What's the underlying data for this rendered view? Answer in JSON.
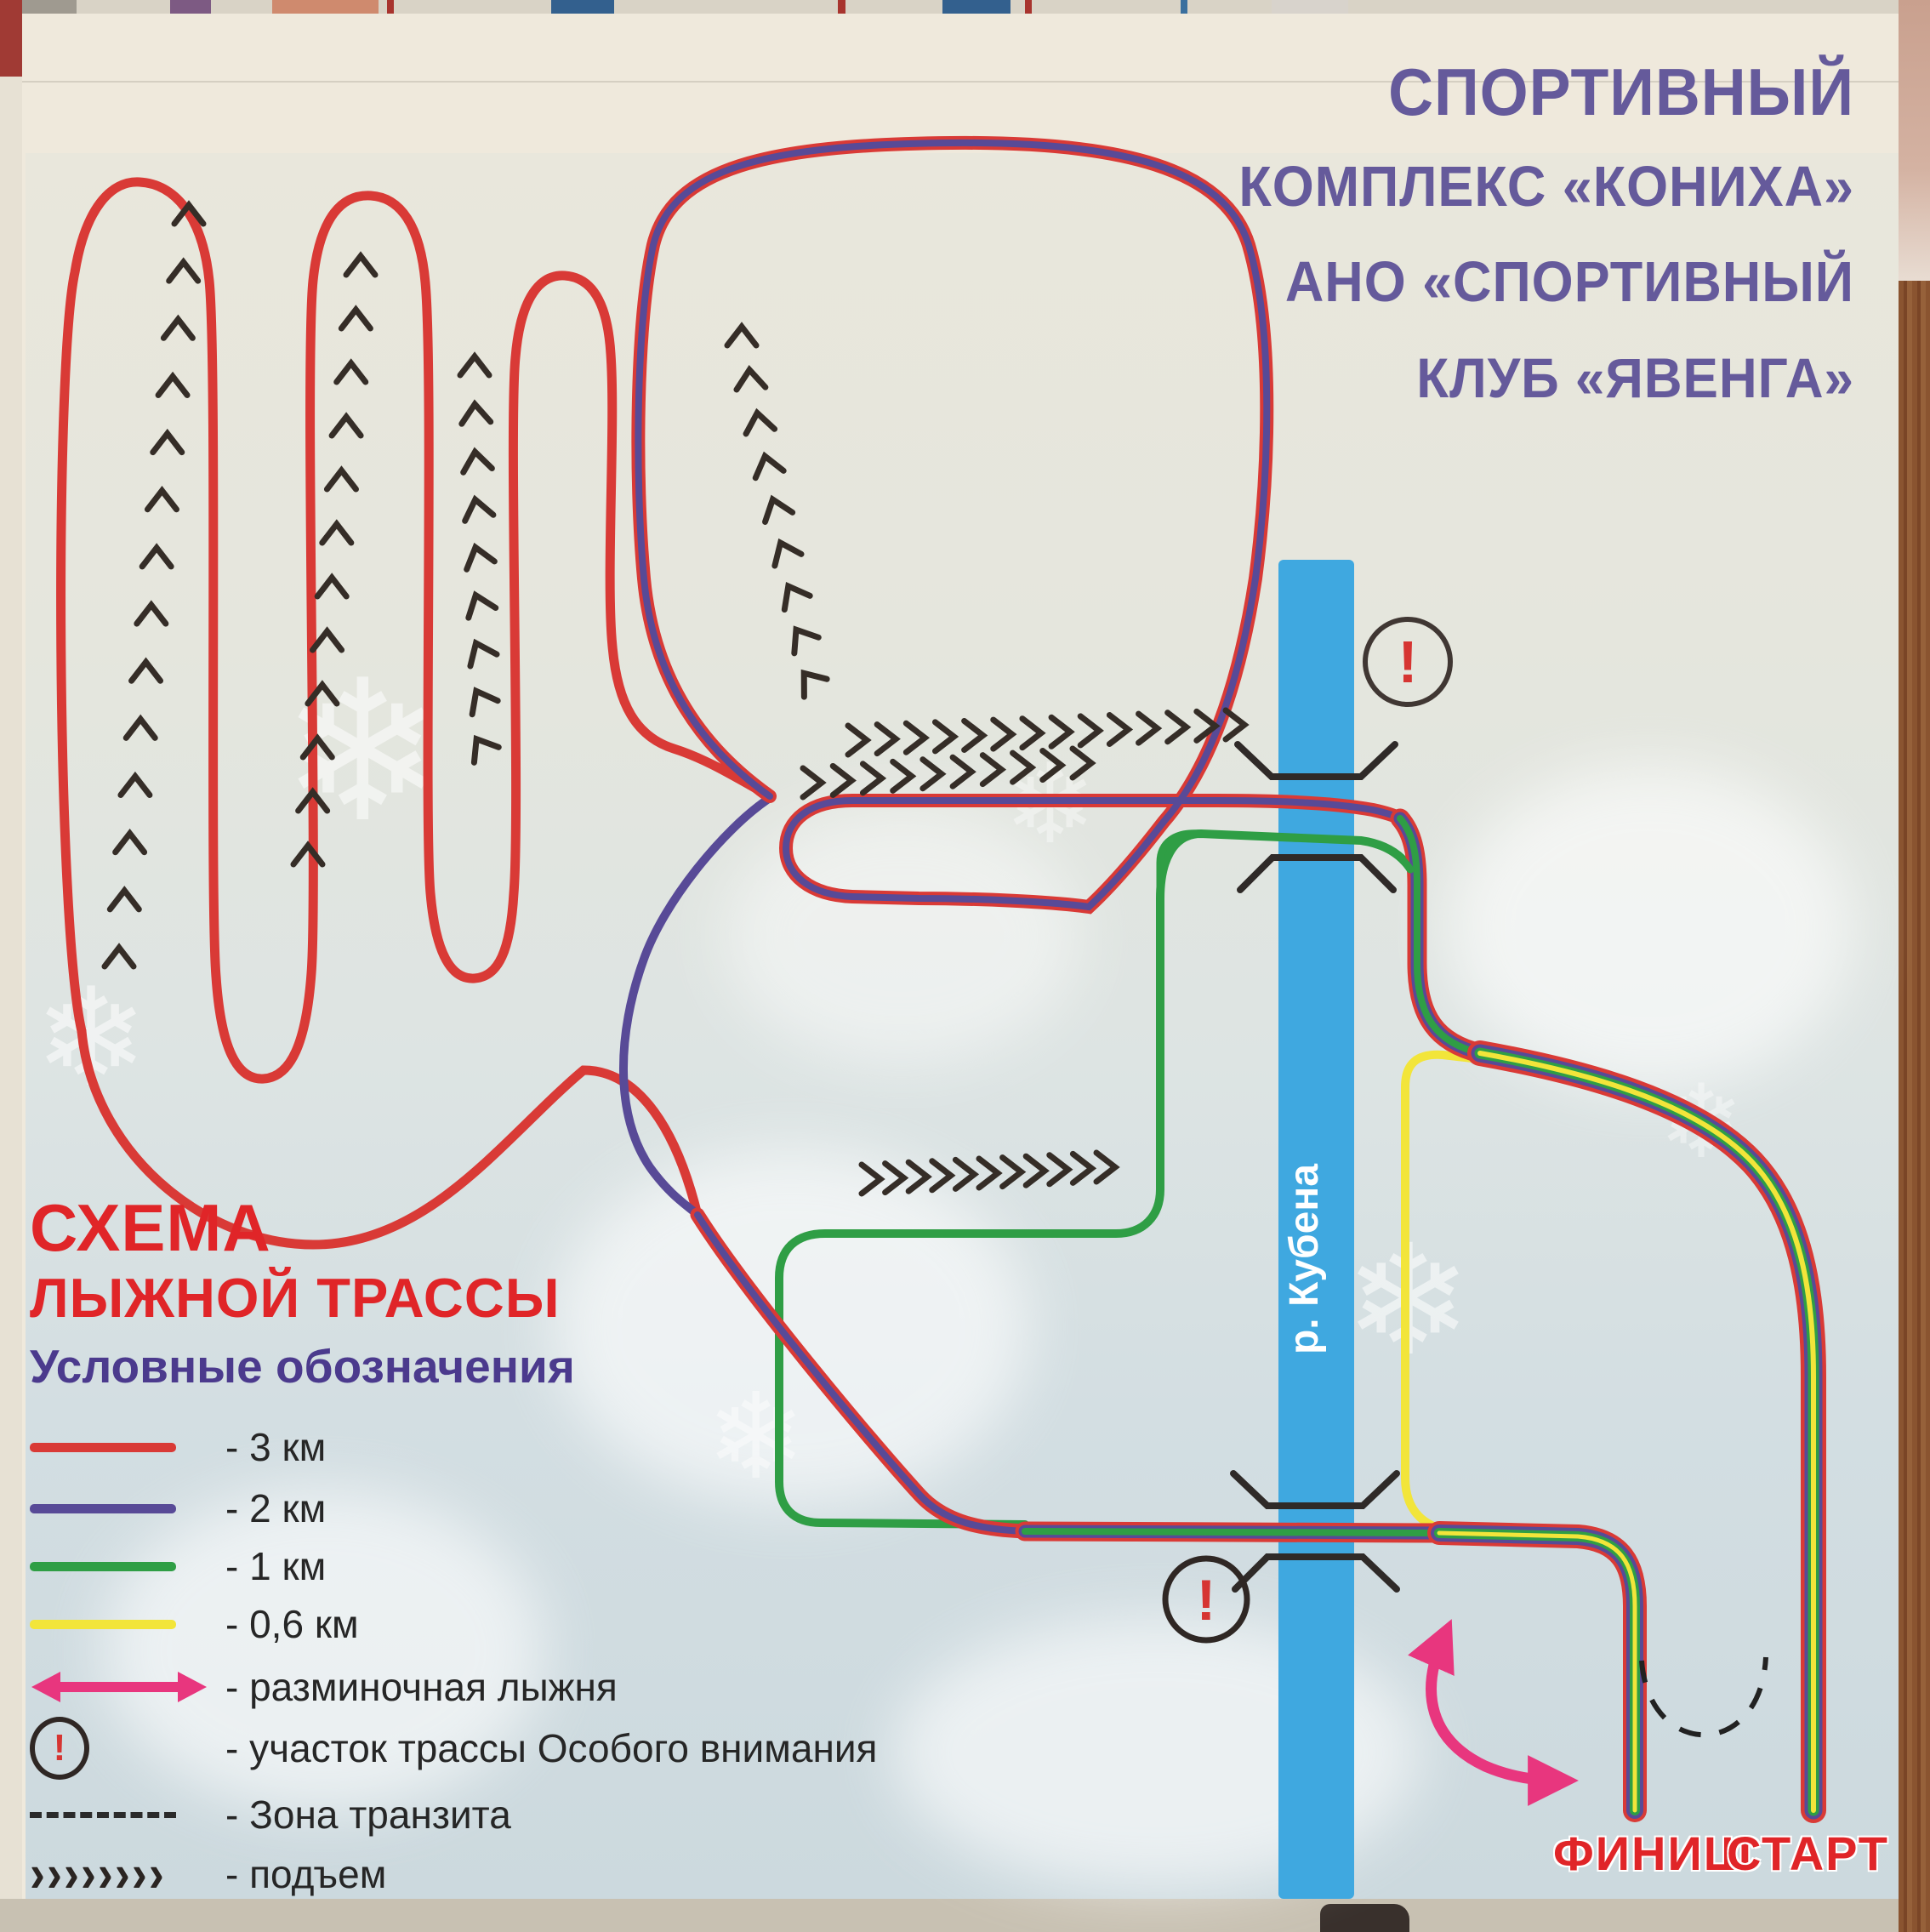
{
  "poster": {
    "club_title": {
      "lines": [
        "СПОРТИВНЫЙ",
        "КОМПЛЕКС «КОНИХА»",
        "АНО «СПОРТИВНЫЙ",
        "КЛУБ «ЯВЕНГА»"
      ]
    },
    "scheme_heading": {
      "title_line1": "СХЕМА",
      "title_line2": "ЛЫЖНОЙ ТРАССЫ",
      "subtitle": "Условные обозначения"
    },
    "legend": {
      "items": [
        {
          "id": "trail-3km",
          "icon": "line",
          "color": "#d93a36",
          "label": "- 3 км"
        },
        {
          "id": "trail-2km",
          "icon": "line",
          "color": "#584a97",
          "label": "- 2 км"
        },
        {
          "id": "trail-1km",
          "icon": "line",
          "color": "#2f9e45",
          "label": "- 1 км"
        },
        {
          "id": "trail-06km",
          "icon": "line",
          "color": "#f2e53a",
          "label": "- 0,6 км"
        },
        {
          "id": "warmup",
          "icon": "double-arrow",
          "color": "#e8367e",
          "label": "- разминочная лыжня"
        },
        {
          "id": "attention",
          "icon": "warning-circle",
          "color": "#d63532",
          "label": "- участок трассы Особого внимания"
        },
        {
          "id": "transit",
          "icon": "dashed-line",
          "color": "#2b2b2b",
          "label": "- Зона транзита"
        },
        {
          "id": "climb",
          "icon": "chevrons",
          "color": "#2b2522",
          "label": "- подъем",
          "glyphs": "››››››››"
        }
      ]
    },
    "map": {
      "river_label": "р. Кубена",
      "finish_label": "ФИНИШ",
      "start_label": "СТАРТ",
      "warning_symbol": "!",
      "river_color": "#3fa8e0",
      "warmup_arrow_color": "#e8367e",
      "trail_colors": {
        "3km": "#d93a36",
        "2km": "#584a97",
        "1km": "#2f9e45",
        "0_6km": "#f2e53a"
      }
    }
  }
}
